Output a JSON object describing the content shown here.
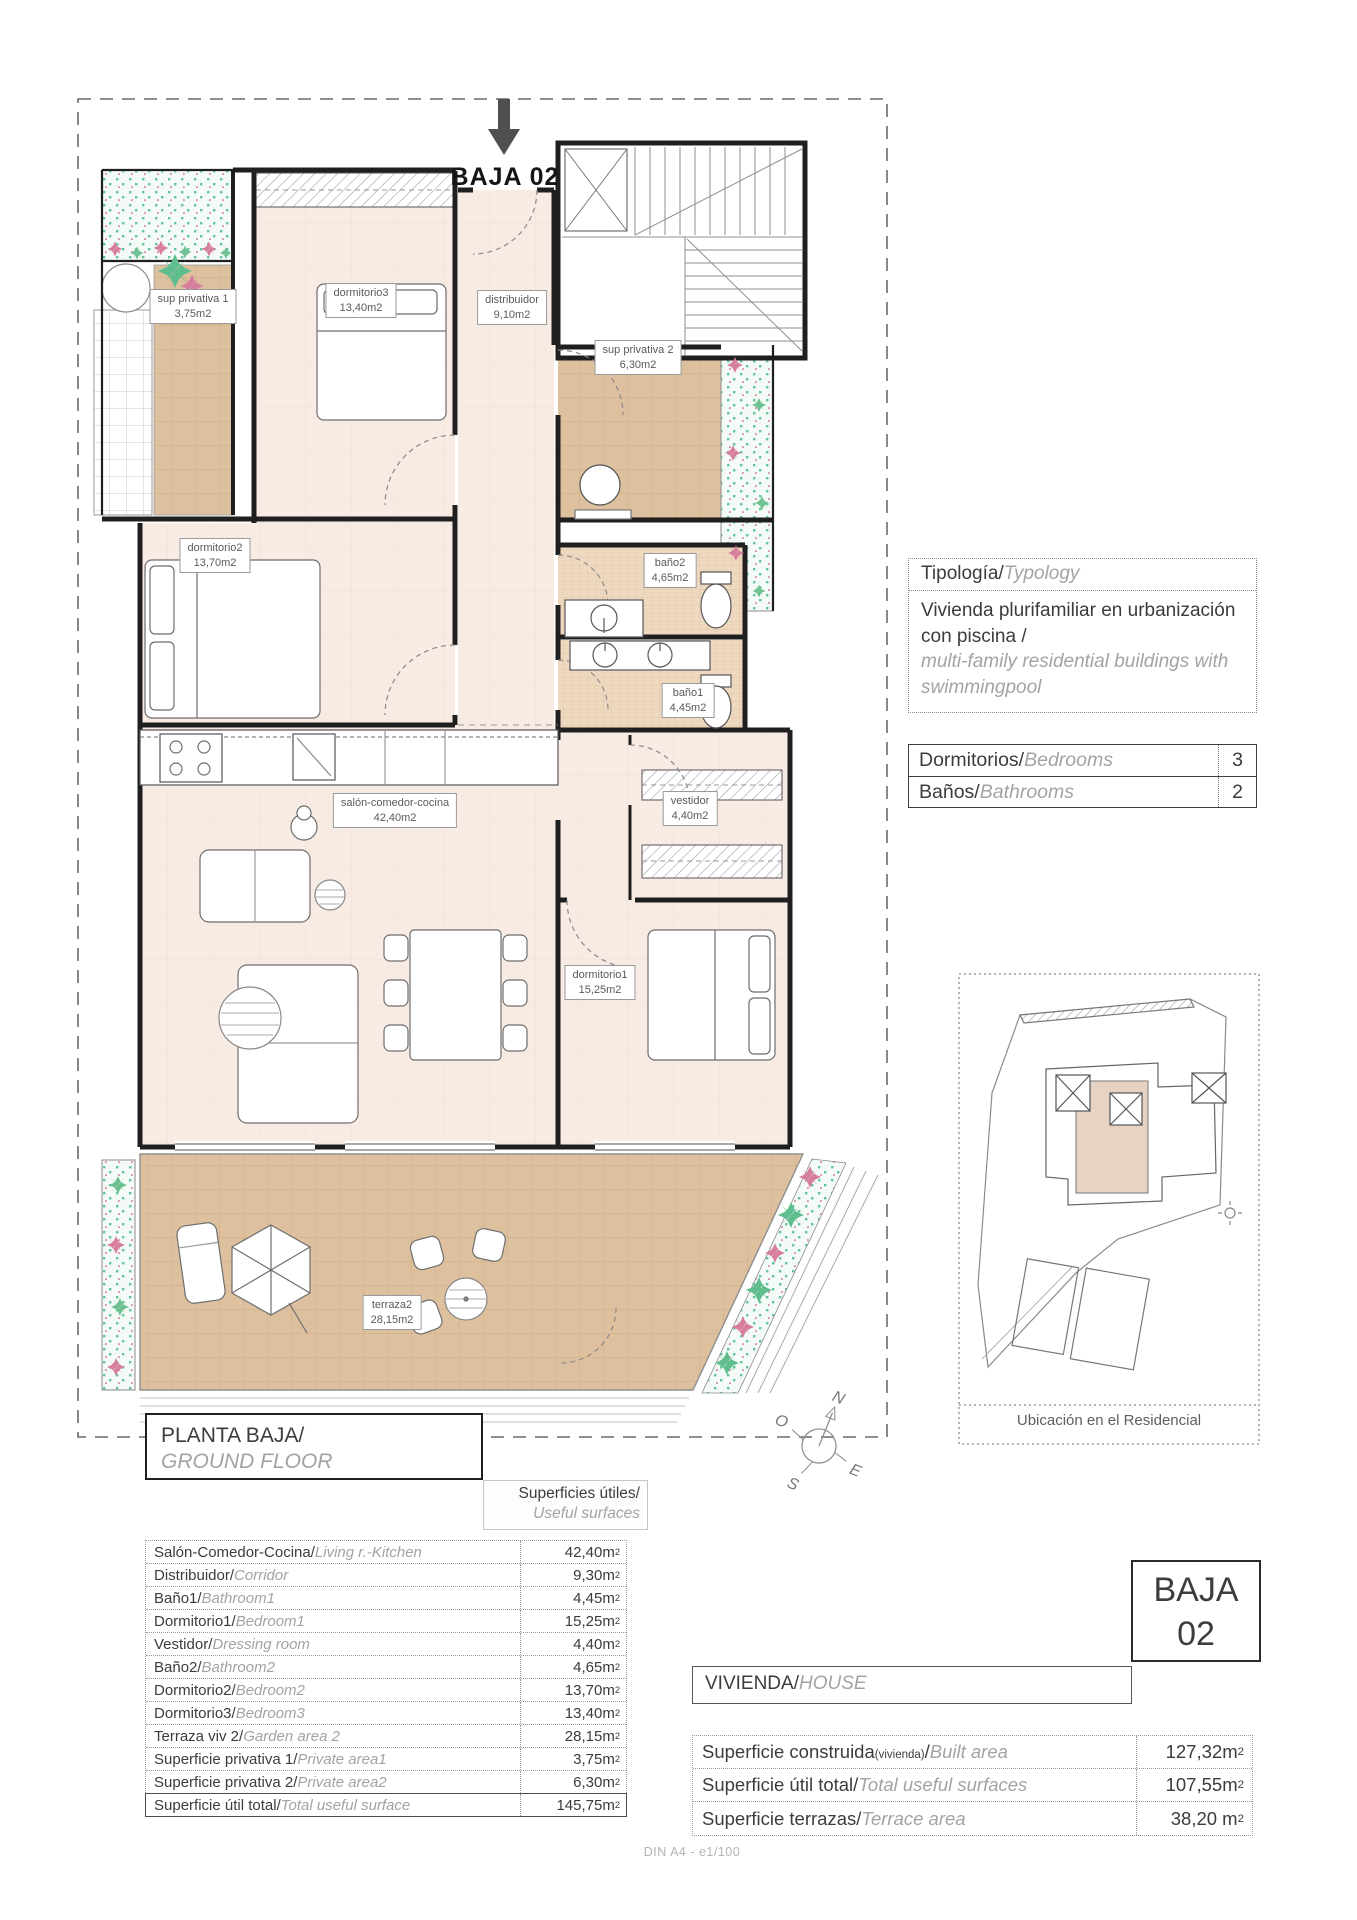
{
  "header": {
    "plan_ref": "BAJA 02"
  },
  "plan": {
    "rooms": [
      {
        "name": "sup privativa 1",
        "area": "3,75m2"
      },
      {
        "name": "dormitorio3",
        "area": "13,40m2"
      },
      {
        "name": "distribuidor",
        "area": "9,10m2"
      },
      {
        "name": "sup privativa 2",
        "area": "6,30m2"
      },
      {
        "name": "dormitorio2",
        "area": "13,70m2"
      },
      {
        "name": "baño2",
        "area": "4,65m2"
      },
      {
        "name": "baño1",
        "area": "4,45m2"
      },
      {
        "name": "salón-comedor-cocina",
        "area": "42,40m2"
      },
      {
        "name": "vestidor",
        "area": "4,40m2"
      },
      {
        "name": "dormitorio1",
        "area": "15,25m2"
      },
      {
        "name": "terraza2",
        "area": "28,15m2"
      }
    ]
  },
  "typology": {
    "title_es": "Tipología/",
    "title_en": "Typology",
    "body_es": "Vivienda plurifamiliar en urbanización con piscina  /",
    "body_en": "multi-family residential buildings with swimmingpool"
  },
  "counts": {
    "rows": [
      {
        "es": "Dormitorios/",
        "en": "Bedrooms",
        "value": "3"
      },
      {
        "es": "Baños/",
        "en": "Bathrooms",
        "value": "2"
      }
    ]
  },
  "site": {
    "caption": "Ubicación en el Residencial"
  },
  "compass": {
    "n": "N",
    "e": "E",
    "s": "S",
    "w": "O"
  },
  "floor_title": {
    "es": "PLANTA BAJA/",
    "en": "GROUND FLOOR"
  },
  "useful": {
    "header_es": "Superficies útiles/",
    "header_en": "Useful surfaces",
    "rows": [
      {
        "es": "Salón-Comedor-Cocina/",
        "en": "Living r.-Kitchen",
        "value": "42,40m",
        "sup": "2"
      },
      {
        "es": "Distribuidor/",
        "en": "Corridor",
        "value": "9,30m",
        "sup": "2"
      },
      {
        "es": "Baño1/",
        "en": "Bathroom1",
        "value": "4,45m",
        "sup": "2"
      },
      {
        "es": "Dormitorio1/",
        "en": "Bedroom1",
        "value": "15,25m",
        "sup": "2"
      },
      {
        "es": "Vestidor/",
        "en": "Dressing room",
        "value": "4,40m",
        "sup": "2"
      },
      {
        "es": "Baño2/",
        "en": "Bathroom2",
        "value": "4,65m",
        "sup": "2"
      },
      {
        "es": "Dormitorio2/",
        "en": "Bedroom2",
        "value": "13,70m",
        "sup": "2"
      },
      {
        "es": "Dormitorio3/",
        "en": "Bedroom3",
        "value": "13,40m",
        "sup": "2"
      },
      {
        "es": "Terraza viv 2/",
        "en": "Garden area 2",
        "value": "28,15m",
        "sup": "2"
      },
      {
        "es": "Superficie privativa 1/",
        "en": "Private area1",
        "value": "3,75m",
        "sup": "2"
      },
      {
        "es": "Superficie privativa 2/",
        "en": "Private area2",
        "value": "6,30m",
        "sup": "2"
      },
      {
        "es": "Superficie útil total/",
        "en": "Total useful surface",
        "value": "145,75m",
        "sup": "2"
      }
    ]
  },
  "badge": {
    "line1": "BAJA",
    "line2": "02"
  },
  "vivienda": {
    "es": "VIVIENDA/",
    "en": "HOUSE"
  },
  "house": {
    "rows": [
      {
        "es": "Superficie construida",
        "es_small": "(vivienda)",
        "es2": "/",
        "en": "Built area",
        "value": "127,32m",
        "sup": "2"
      },
      {
        "es": "Superficie útil total/",
        "es_small": "",
        "es2": "",
        "en": "Total useful surfaces",
        "value": "107,55m",
        "sup": "2"
      },
      {
        "es": "Superficie terrazas/",
        "es_small": "",
        "es2": "",
        "en": "Terrace area",
        "value": "38,20 m",
        "sup": "2"
      }
    ]
  },
  "footer": {
    "text": "DIN A4 - e1/100"
  }
}
